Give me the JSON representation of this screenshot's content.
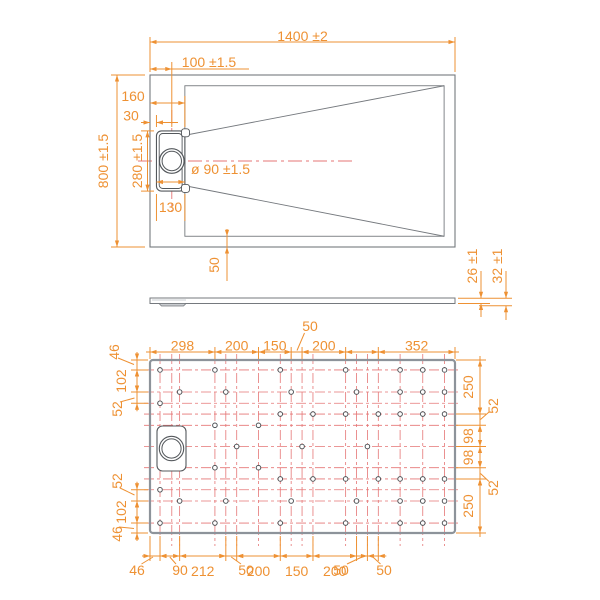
{
  "colors": {
    "dimension": "#ee9133",
    "construction": "#e57676",
    "outline": "#75797e",
    "outline_strong": "#8d939a",
    "detail": "#54585c",
    "shade": "#c9ccd0",
    "background": "#ffffff"
  },
  "top_view": {
    "overall_width": "1400 ±2",
    "drain_offset": "100 ±1.5",
    "edge_to_slot_right": "160",
    "edge_to_slot_left": "30",
    "overall_height": "800 ±1.5",
    "slot_length": "280 ±1.5",
    "slot_width": "130",
    "drain_diameter": "ø 90 ±1.5",
    "border_width": "50"
  },
  "profile_view": {
    "edge_thickness": "26 ±1",
    "total_thickness": "32 ±1"
  },
  "bottom_view": {
    "top_chain": [
      "298",
      "200",
      "150",
      "200",
      "352"
    ],
    "top_leader": "50",
    "left_chain": [
      "46",
      "102",
      "52",
      "52",
      "102",
      "46"
    ],
    "right_chain": [
      "250",
      "98",
      "98",
      "250"
    ],
    "right_leaders": [
      "52",
      "52"
    ],
    "bottom_chain": [
      "212",
      "200",
      "150",
      "200"
    ],
    "bottom_leaders": [
      "46",
      "90",
      "50",
      "50",
      "50"
    ],
    "construction_rows_mm": [
      46,
      148,
      200,
      250,
      302,
      400,
      498,
      550,
      600,
      652,
      754
    ],
    "construction_cols_mm": [
      46,
      100,
      136,
      298,
      348,
      398,
      498,
      598,
      648,
      698,
      748,
      898,
      948,
      998,
      1048,
      1148,
      1252,
      1352
    ],
    "holes_mm": [
      {
        "y": 46,
        "x": [
          46,
          298,
          598,
          898,
          1148,
          1252,
          1352
        ]
      },
      {
        "y": 148,
        "x": [
          136,
          348,
          648,
          948,
          1148,
          1252,
          1352
        ]
      },
      {
        "y": 200,
        "x": [
          46
        ]
      },
      {
        "y": 250,
        "x": [
          598,
          748,
          898,
          1048,
          1148,
          1252,
          1352
        ]
      },
      {
        "y": 302,
        "x": [
          298,
          498
        ]
      },
      {
        "y": 400,
        "x": [
          398,
          698,
          998
        ]
      },
      {
        "y": 498,
        "x": [
          298,
          498
        ]
      },
      {
        "y": 550,
        "x": [
          598,
          748,
          898,
          1048,
          1148,
          1252,
          1352
        ]
      },
      {
        "y": 600,
        "x": [
          46
        ]
      },
      {
        "y": 652,
        "x": [
          136,
          348,
          648,
          948,
          1148,
          1252,
          1352
        ]
      },
      {
        "y": 754,
        "x": [
          46,
          298,
          598,
          898,
          1148,
          1252,
          1352
        ]
      }
    ]
  }
}
